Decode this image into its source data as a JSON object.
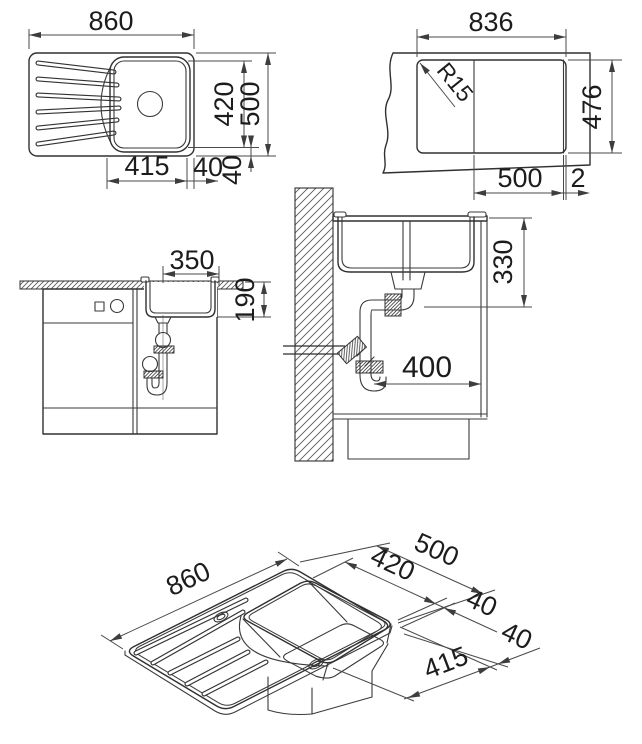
{
  "drawing": {
    "top_view": {
      "overall_width": "860",
      "bowl_depth": "420",
      "overall_depth": "500",
      "bowl_width": "415",
      "side_gap": "40",
      "bottom_gap": "40"
    },
    "cutout_view": {
      "cutout_width": "836",
      "corner_radius": "R15",
      "cutout_depth": "476",
      "bowl_section_width": "500",
      "overhang": "2"
    },
    "front_view": {
      "drain_to_back": "350",
      "bowl_height": "190"
    },
    "section_view": {
      "outlet_drop": "330",
      "outlet_wall_offset": "400"
    },
    "iso_view": {
      "overall_width": "860",
      "overall_depth": "500",
      "bowl_depth": "420",
      "rim_gap_a": "40",
      "rim_gap_b": "40",
      "bowl_width": "415"
    }
  }
}
